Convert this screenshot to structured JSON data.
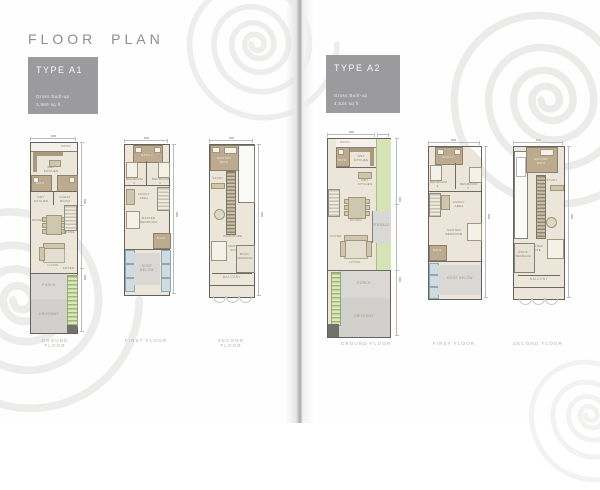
{
  "page": {
    "title": "FLOOR PLAN"
  },
  "units": {
    "a1": {
      "type_label": "TYPE A1",
      "gross_label": "Gross Built-up",
      "gross_value": "3,966 sq ft",
      "floors": [
        {
          "label": "GROUND FLOOR"
        },
        {
          "label": "FIRST FLOOR"
        },
        {
          "label": "SECOND FLOOR"
        }
      ]
    },
    "a2": {
      "type_label": "TYPE A2",
      "gross_label": "Gross Built-up",
      "gross_value": "4,534 sq ft",
      "floors": [
        {
          "label": "GROUND FLOOR"
        },
        {
          "label": "FIRST FLOOR"
        },
        {
          "label": "SECOND FLOOR"
        }
      ]
    }
  },
  "plans": {
    "a1_ground": {
      "rooms": {
        "patio": "PATIO",
        "wet_kitchen": "WET KITCHEN",
        "bath": "BATH",
        "dry_kitchen": "DRY KITCHEN",
        "guest_room": "GUEST ROOM",
        "store": "STORE",
        "dining": "DINING",
        "living": "LIVING",
        "foyer": "FOYER",
        "porch": "PORCH",
        "driveway": "DRIVEWAY"
      }
    },
    "a1_first": {
      "rooms": {
        "bath2": "BATH 2",
        "bedroom3": "BEDROOM 3",
        "bedroom2": "BEDROOM 2",
        "family": "FAMILY AREA",
        "master_bedroom": "MASTER BEDROOM",
        "bath": "BATH",
        "roof_below": "ROOF BELOW"
      }
    },
    "a1_second": {
      "rooms": {
        "master_bath": "MASTER BATH",
        "study": "STUDY",
        "wardrobe": "WARDROBE",
        "master_suite": "MASTER SUITE",
        "roof_terrace": "ROOF TERRACE",
        "balcony": "BALCONY"
      }
    },
    "a2_ground": {
      "rooms": {
        "patio": "PATIO",
        "bath": "BATH",
        "wet_kitchen": "WET KITCHEN",
        "dry_kitchen": "DRY KITCHEN",
        "dining": "DINING",
        "terrace": "TERRACE",
        "foyer": "FOYER",
        "living": "LIVING",
        "porch": "PORCH",
        "driveway": "DRIVEWAY"
      }
    },
    "a2_first": {
      "rooms": {
        "bath2": "BATH 2",
        "bedroom3": "BEDROOM 3",
        "bedroom2": "BEDROOM 2",
        "family": "FAMILY AREA",
        "master_bedroom": "MASTER BEDROOM",
        "bath": "BATH",
        "roof_below": "ROOF BELOW"
      }
    },
    "a2_second": {
      "rooms": {
        "master_bath": "MASTER BATH",
        "study": "STUDY",
        "master_suite": "MASTER SUITE",
        "roof_terrace": "ROOF TERRACE",
        "balcony": "BALCONY"
      }
    }
  },
  "colors": {
    "type_card_bg": "#9b9b9d",
    "plan_floor": "#ebe6d9",
    "garden_green": "#d5e3b6",
    "hardscape_gray": "#d9d8d4",
    "title_gray": "#8d8d8d"
  }
}
